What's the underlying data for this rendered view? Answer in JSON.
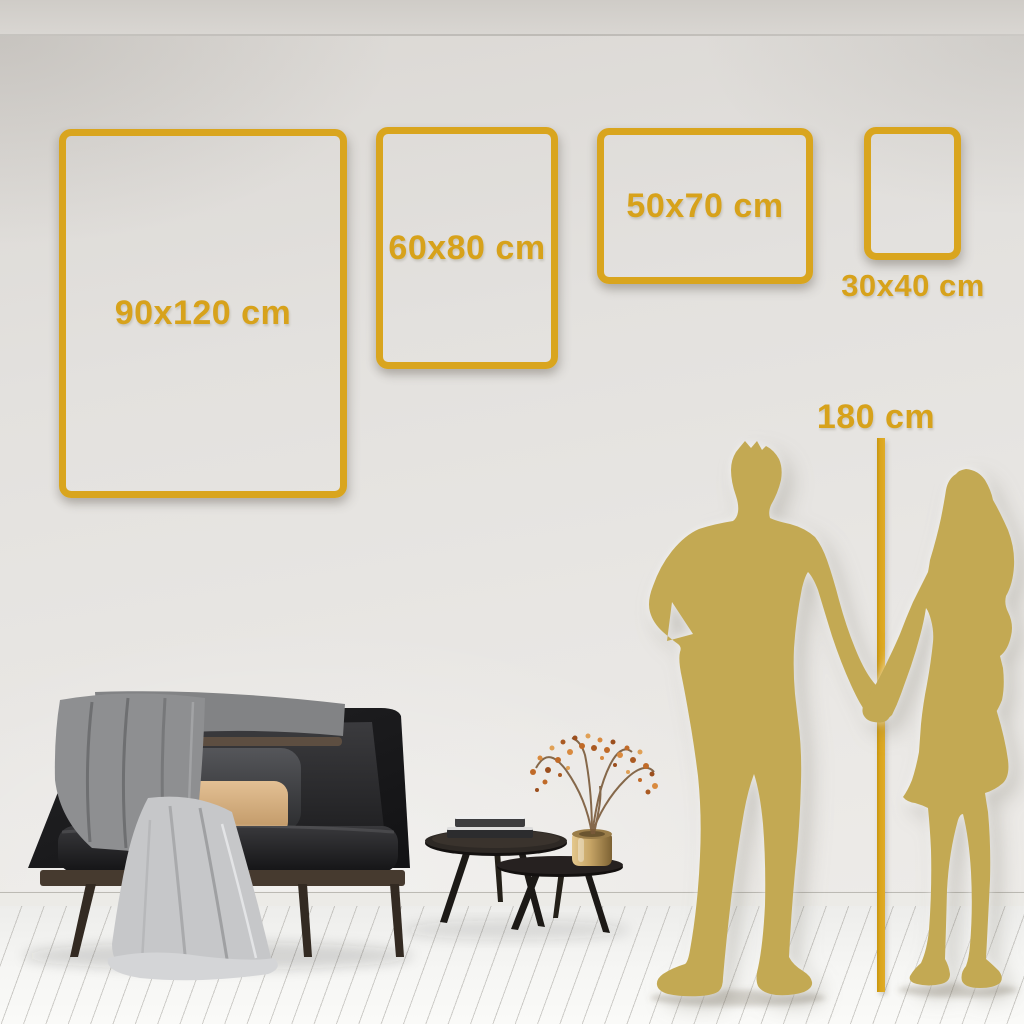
{
  "sizes": [
    {
      "id": "90x120",
      "label": "90x120 cm"
    },
    {
      "id": "60x80",
      "label": "60x80 cm"
    },
    {
      "id": "50x70",
      "label": "50x70 cm"
    },
    {
      "id": "30x40",
      "label": "30x40 cm"
    }
  ],
  "height_marker": {
    "label": "180 cm"
  },
  "colors": {
    "gold_accent": "#D9A51E",
    "silhouette_gold": "#C3A953",
    "wall": "#E3E1DE",
    "floor": "#F5F5F3",
    "tan_pillow": "#D9B285"
  }
}
